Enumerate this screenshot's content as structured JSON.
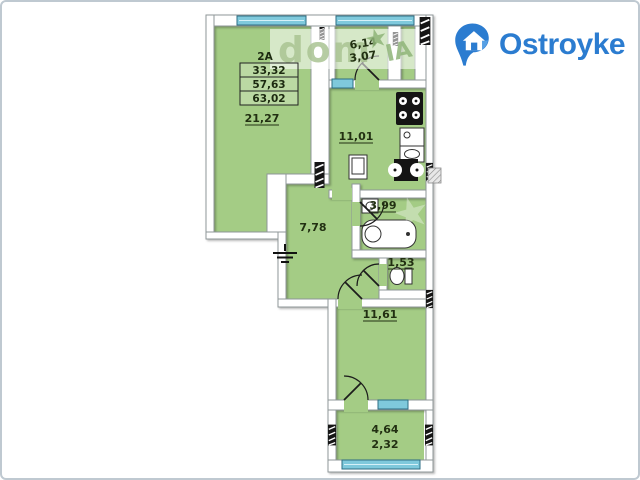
{
  "brand": {
    "name": "Ostroyke",
    "color": "#2b7cd0",
    "icon": "house-pin-icon"
  },
  "watermark": {
    "left": "dom",
    "right": "IA",
    "star": "★"
  },
  "floor_plan": {
    "unit_label": "2А",
    "unit_stats": [
      "33,32",
      "57,63",
      "63,02"
    ],
    "rooms": {
      "living": "21,27",
      "kitchen": "11,01",
      "hall": "7,78",
      "bathroom": "3,99",
      "wc": "1,53",
      "bedroom": "11,61",
      "loggia_top": [
        "6,14",
        "3,07"
      ],
      "loggia_bottom": [
        "4,64",
        "2,32"
      ]
    },
    "colors": {
      "room_fill": "#a4cc85",
      "wall_fill": "#ffffff",
      "wall_outline": "#8f9798",
      "window_fill": "#7fc9dc",
      "window_frame": "#2e6e84",
      "label_color": "#223012"
    }
  }
}
